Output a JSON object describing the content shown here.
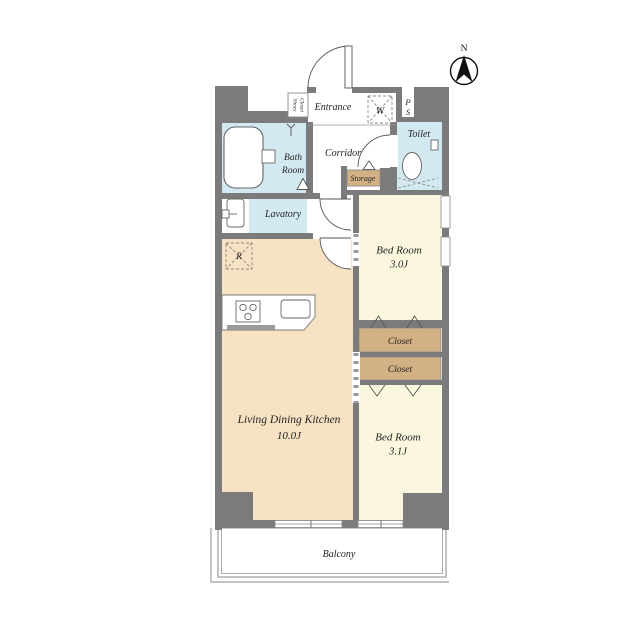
{
  "compass": {
    "north_label": "N"
  },
  "rooms": {
    "entrance": {
      "label": "Entrance"
    },
    "shoes_closet": {
      "line1": "Shoes",
      "line2": "Closet"
    },
    "corridor": {
      "label": "Corridor"
    },
    "bath": {
      "line1": "Bath",
      "line2": "Room"
    },
    "lavatory": {
      "label": "Lavatory"
    },
    "toilet": {
      "label": "Toilet"
    },
    "storage": {
      "label": "Storage"
    },
    "washer": {
      "label": "W"
    },
    "pipe_space": {
      "line1": "P",
      "line2": "S"
    },
    "refrigerator": {
      "label": "R"
    },
    "bedroom1": {
      "label": "Bed Room",
      "size": "3.0J"
    },
    "closet1": {
      "label": "Closet"
    },
    "closet2": {
      "label": "Closet"
    },
    "bedroom2": {
      "label": "Bed Room",
      "size": "3.1J"
    },
    "ldk": {
      "label": "Living Dining Kitchen",
      "size": "10.0J"
    },
    "balcony": {
      "label": "Balcony"
    }
  },
  "colors": {
    "wall": "#7b7b7b",
    "ldk": "#f7e3c3",
    "bed": "#fbf7de",
    "wet": "#d3e9f1",
    "closet": "#d2b285",
    "white": "#ffffff",
    "counter_edge": "#9a9a9a"
  }
}
